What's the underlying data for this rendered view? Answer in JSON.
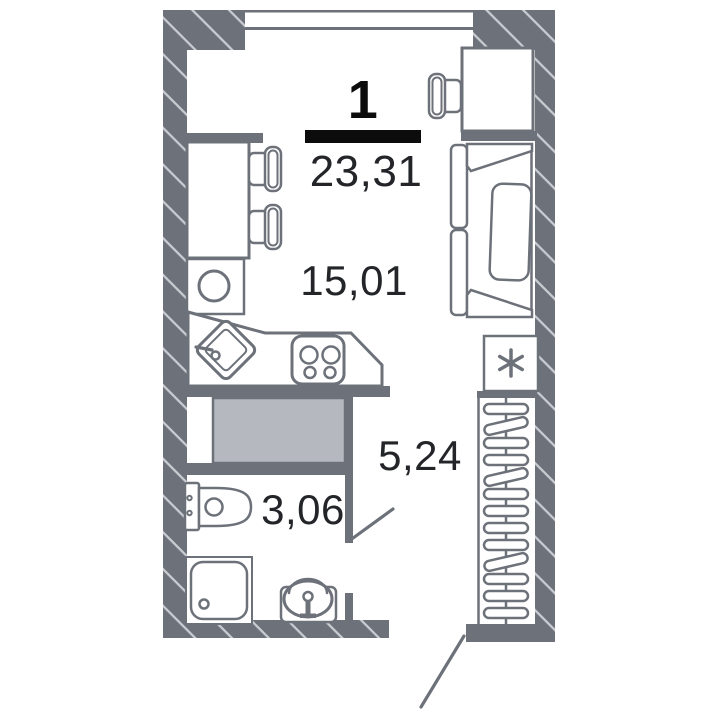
{
  "floorplan": {
    "apartment_number": "1",
    "total_area": "23,31",
    "rooms": [
      {
        "id": "living-room",
        "area": "15,01"
      },
      {
        "id": "hallway",
        "area": "5,24"
      },
      {
        "id": "bathroom",
        "area": "3,06"
      }
    ]
  },
  "icons": {
    "fridge": "asterisk-icon",
    "washing_machine": "drum-circle-icon",
    "wardrobe": "hanger-rail-icon"
  },
  "colors": {
    "wall": "#6d727a",
    "hatch": "#c9ccd1",
    "closet": "#b5b9bf",
    "text": "#232529",
    "black": "#0c0c0c",
    "bg": "#ffffff"
  }
}
